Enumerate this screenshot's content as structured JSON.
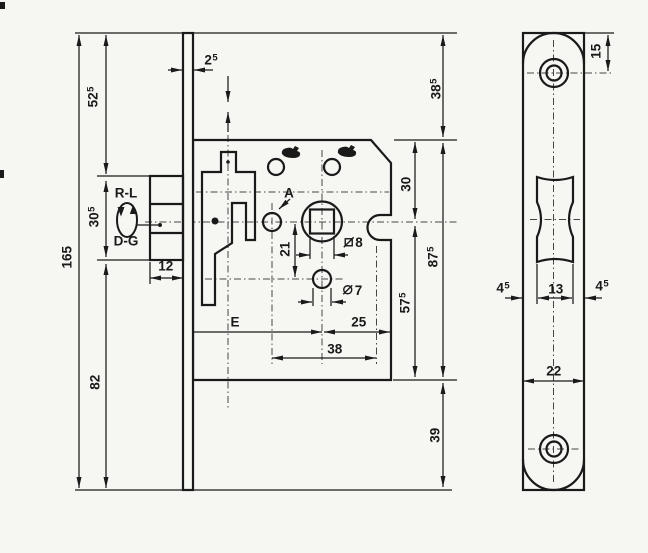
{
  "colors": {
    "ink": "#1a1a1a",
    "paper": "#f6f6f2"
  },
  "symbols": {
    "handing_top": "R-L",
    "handing_bottom": "D-G",
    "reference_point": "A"
  },
  "dimensions": {
    "total_height": {
      "value": "165"
    },
    "top_to_latch": {
      "value": "52",
      "sup": "5"
    },
    "latch_height": {
      "value": "30",
      "sup": "5"
    },
    "latch_to_bottom": {
      "value": "82"
    },
    "faceplate_thickness": {
      "value": "2",
      "sup": "5"
    },
    "latch_projection": {
      "value": "12"
    },
    "top_to_case": {
      "value": "38",
      "sup": "5"
    },
    "case_top_to_spindle": {
      "value": "30"
    },
    "case_height": {
      "value": "87",
      "sup": "5"
    },
    "spindle_to_case_bottom": {
      "value": "57",
      "sup": "5"
    },
    "case_bottom_to_end": {
      "value": "39"
    },
    "spindle_to_cylinder": {
      "value": "21"
    },
    "spindle_square": {
      "symbol": "square-section",
      "value": "8"
    },
    "cylinder_hole": {
      "symbol": "diameter",
      "value": "7"
    },
    "backset": {
      "value": "E"
    },
    "spindle_to_edge": {
      "value": "25"
    },
    "hole_spacing": {
      "value": "38"
    },
    "plate_top_to_screw": {
      "value": "15"
    },
    "plate_margin_left": {
      "value": "4",
      "sup": "5"
    },
    "cutout_width": {
      "value": "13"
    },
    "plate_margin_right": {
      "value": "4",
      "sup": "5"
    },
    "plate_width": {
      "value": "22"
    }
  }
}
